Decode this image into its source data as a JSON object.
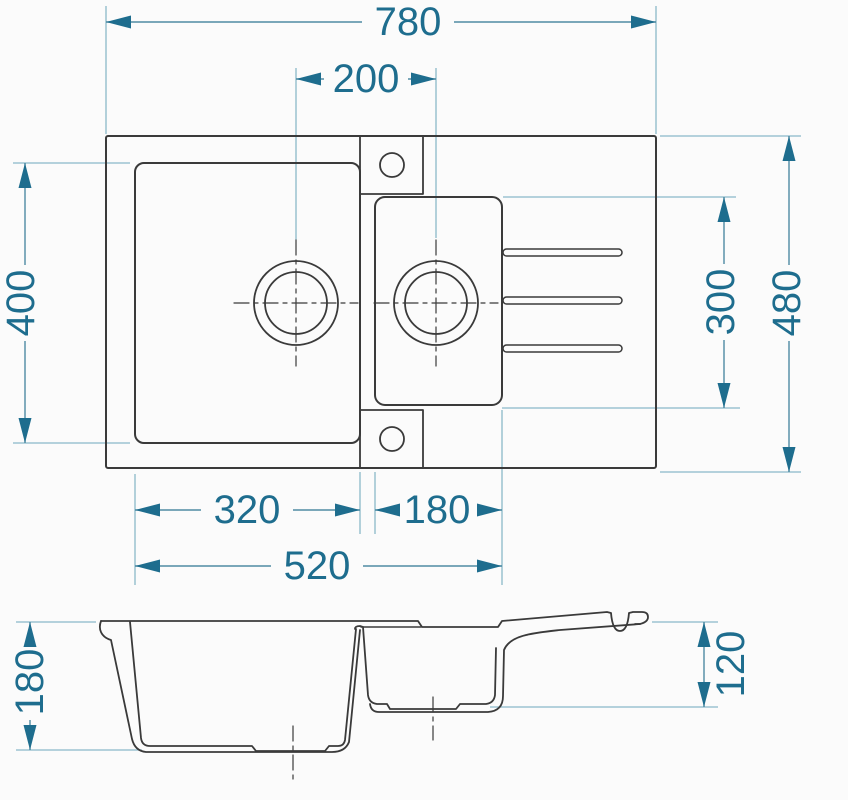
{
  "drawing": {
    "subject": "kitchen sink with one and a half bowls and drainboard",
    "views": {
      "top_view": "plan view",
      "section_view": "front section view"
    }
  },
  "colors": {
    "background": "#fbfbfb",
    "outline": "#3a3a3a",
    "dimension_line": "#4f8ba3",
    "dimension_accent": "#1e6d8e",
    "extension_line": "#8ab8c9"
  },
  "dimensions": {
    "overall_width": "780",
    "drain_center_offset": "200",
    "main_bowl_length": "400",
    "right_section_length": "300",
    "overall_depth": "480",
    "main_bowl_width": "320",
    "small_bowl_width": "180",
    "bowls_total_width": "520",
    "main_bowl_depth": "180",
    "small_bowl_depth": "120"
  }
}
